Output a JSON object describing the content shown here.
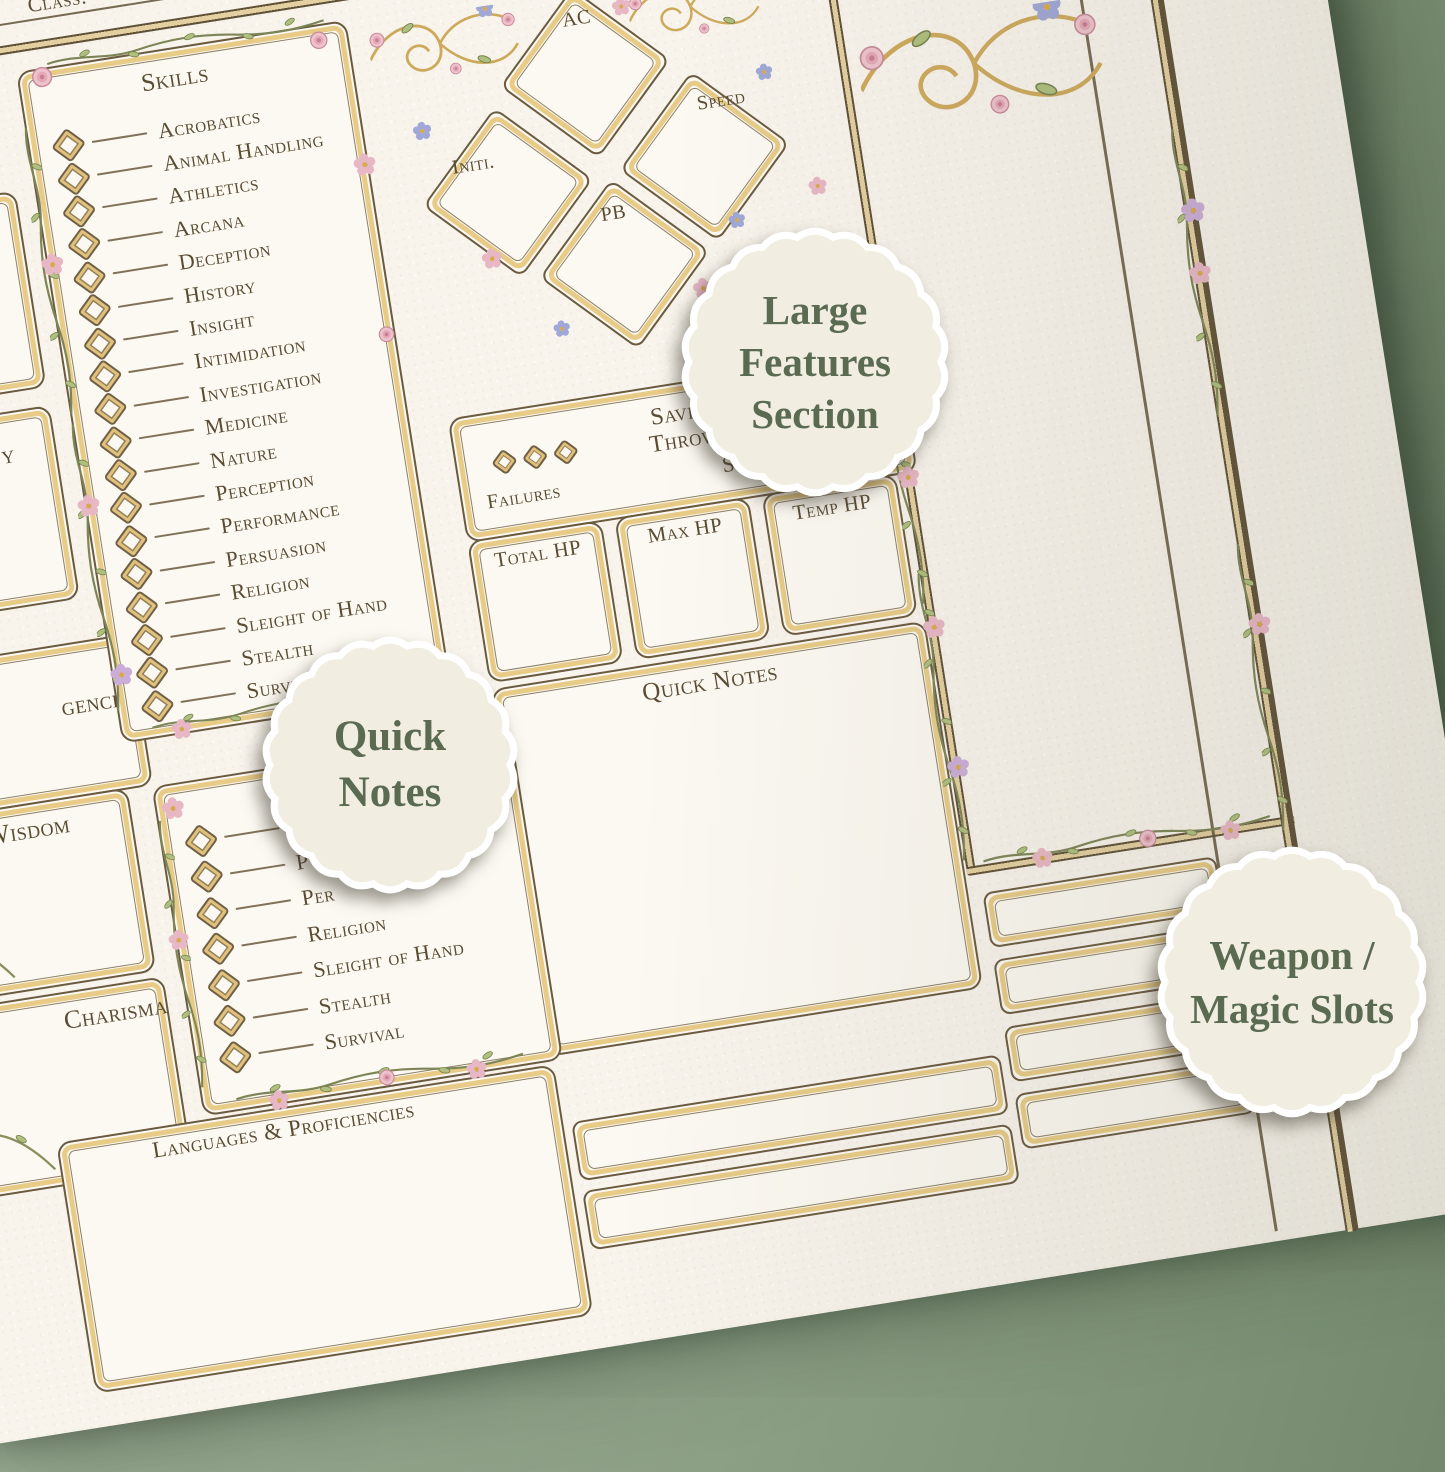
{
  "sheet": {
    "class_label": "Class:",
    "skills_box": {
      "title": "Skills",
      "items": [
        "Acrobatics",
        "Animal Handling",
        "Athletics",
        "Arcana",
        "Deception",
        "History",
        "Insight",
        "Intimidation",
        "Investigation",
        "Medicine",
        "Nature",
        "Perception",
        "Performance",
        "Persuasion",
        "Religion",
        "Sleight of Hand",
        "Stealth",
        "Survival"
      ]
    },
    "stat_diamonds": [
      "AC",
      "Initi.",
      "Speed",
      "PB"
    ],
    "saving_throws": {
      "title_line1": "Saving",
      "title_line2": "Throws",
      "failures_label": "Failures",
      "successes_fragment": "S"
    },
    "hp_boxes": [
      "Total HP",
      "Max HP",
      "Temp HP"
    ],
    "quick_notes_title": "Quick Notes",
    "ability_labels": {
      "partial_dexterity": "y",
      "partial_intelligence": "gence",
      "wisdom": "Wisdom",
      "charisma": "Charisma"
    },
    "skills_box_2": {
      "items": [
        "Sa",
        "P",
        "Per",
        "Religion",
        "Sleight of Hand",
        "Stealth",
        "Survival"
      ]
    },
    "languages_title": "Languages & Proficiencies"
  },
  "badges": [
    {
      "id": "large-features-section",
      "lines": [
        "Large",
        "Features",
        "Section"
      ]
    },
    {
      "id": "quick-notes",
      "lines": [
        "Quick",
        "Notes"
      ]
    },
    {
      "id": "weapon-magic-slots",
      "lines": [
        "Weapon /",
        "Magic Slots"
      ]
    }
  ],
  "colors": {
    "background_green": "#8fa389",
    "paper": "#f8f4ec",
    "gold_border": "#e7cb87",
    "ink": "#5a4c33",
    "badge_background": "#f1ede1",
    "badge_text": "#5a6b52"
  },
  "decorations": [
    "vine",
    "leaf",
    "pink-flower",
    "blue-flower",
    "rose",
    "gold-filigree",
    "vine-arch"
  ]
}
